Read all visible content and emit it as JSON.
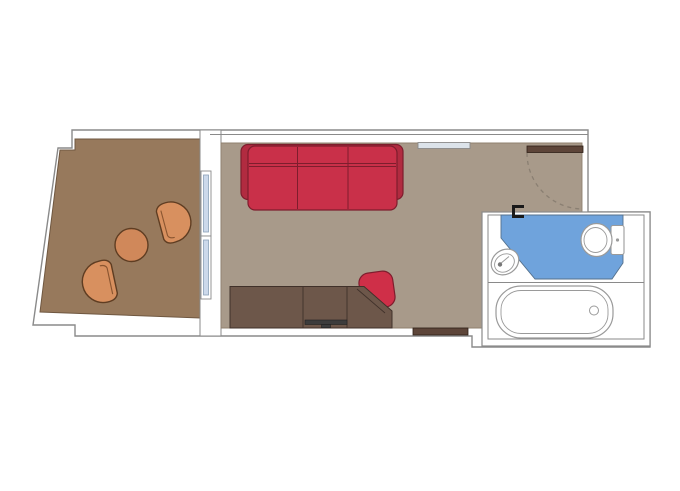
{
  "colors": {
    "background": "#ffffff",
    "wall_fill": "#ffffff",
    "wall_outline": "#8a8a8a",
    "balcony_floor": "#97795c",
    "balcony_floor_outline": "#6f5740",
    "room_floor": "#a89a8a",
    "room_floor_outline": "#8f806f",
    "sofa_back": "#b12b40",
    "sofa_cushion": "#c93049",
    "sofa_outline": "#7e1d2d",
    "armchair_fill": "#d8905f",
    "armchair_outline": "#5f3d22",
    "armchair_inner": "#8a5530",
    "table_fill": "#d0885a",
    "desk_fill": "#6d574a",
    "desk_outline": "#40312a",
    "desk_chair_fill": "#cf2f48",
    "tv_fill": "#3c3c3c",
    "tv_outline": "#222222",
    "door_fill": "#5d4539",
    "door_outline": "#2f2017",
    "door_swing": "#8a7f72",
    "shelf_fill": "#dce3ea",
    "glass_fill": "#ccd9eb",
    "glass_frame": "#8aa0b8",
    "bath_floor": "#6fa3dc",
    "bath_floor_outline": "#55718c",
    "fixture_fill": "#ffffff",
    "fixture_outline": "#9a9a9a",
    "faucet_dot": "#777777",
    "hinge": "#1a1a1a"
  },
  "floor_plan": {
    "type": "cabin-floor-plan",
    "rooms": [
      {
        "name": "balcony",
        "furniture": [
          "armchair",
          "armchair",
          "round-table"
        ]
      },
      {
        "name": "main-cabin",
        "furniture": [
          "sofa",
          "desk-cabinet",
          "desk-chair",
          "tv",
          "entrance-door",
          "wall-shelf",
          "sliding-glass-door",
          "threshold-cabinet"
        ]
      },
      {
        "name": "bathroom",
        "furniture": [
          "washbasin",
          "toilet",
          "bathtub"
        ]
      }
    ]
  }
}
